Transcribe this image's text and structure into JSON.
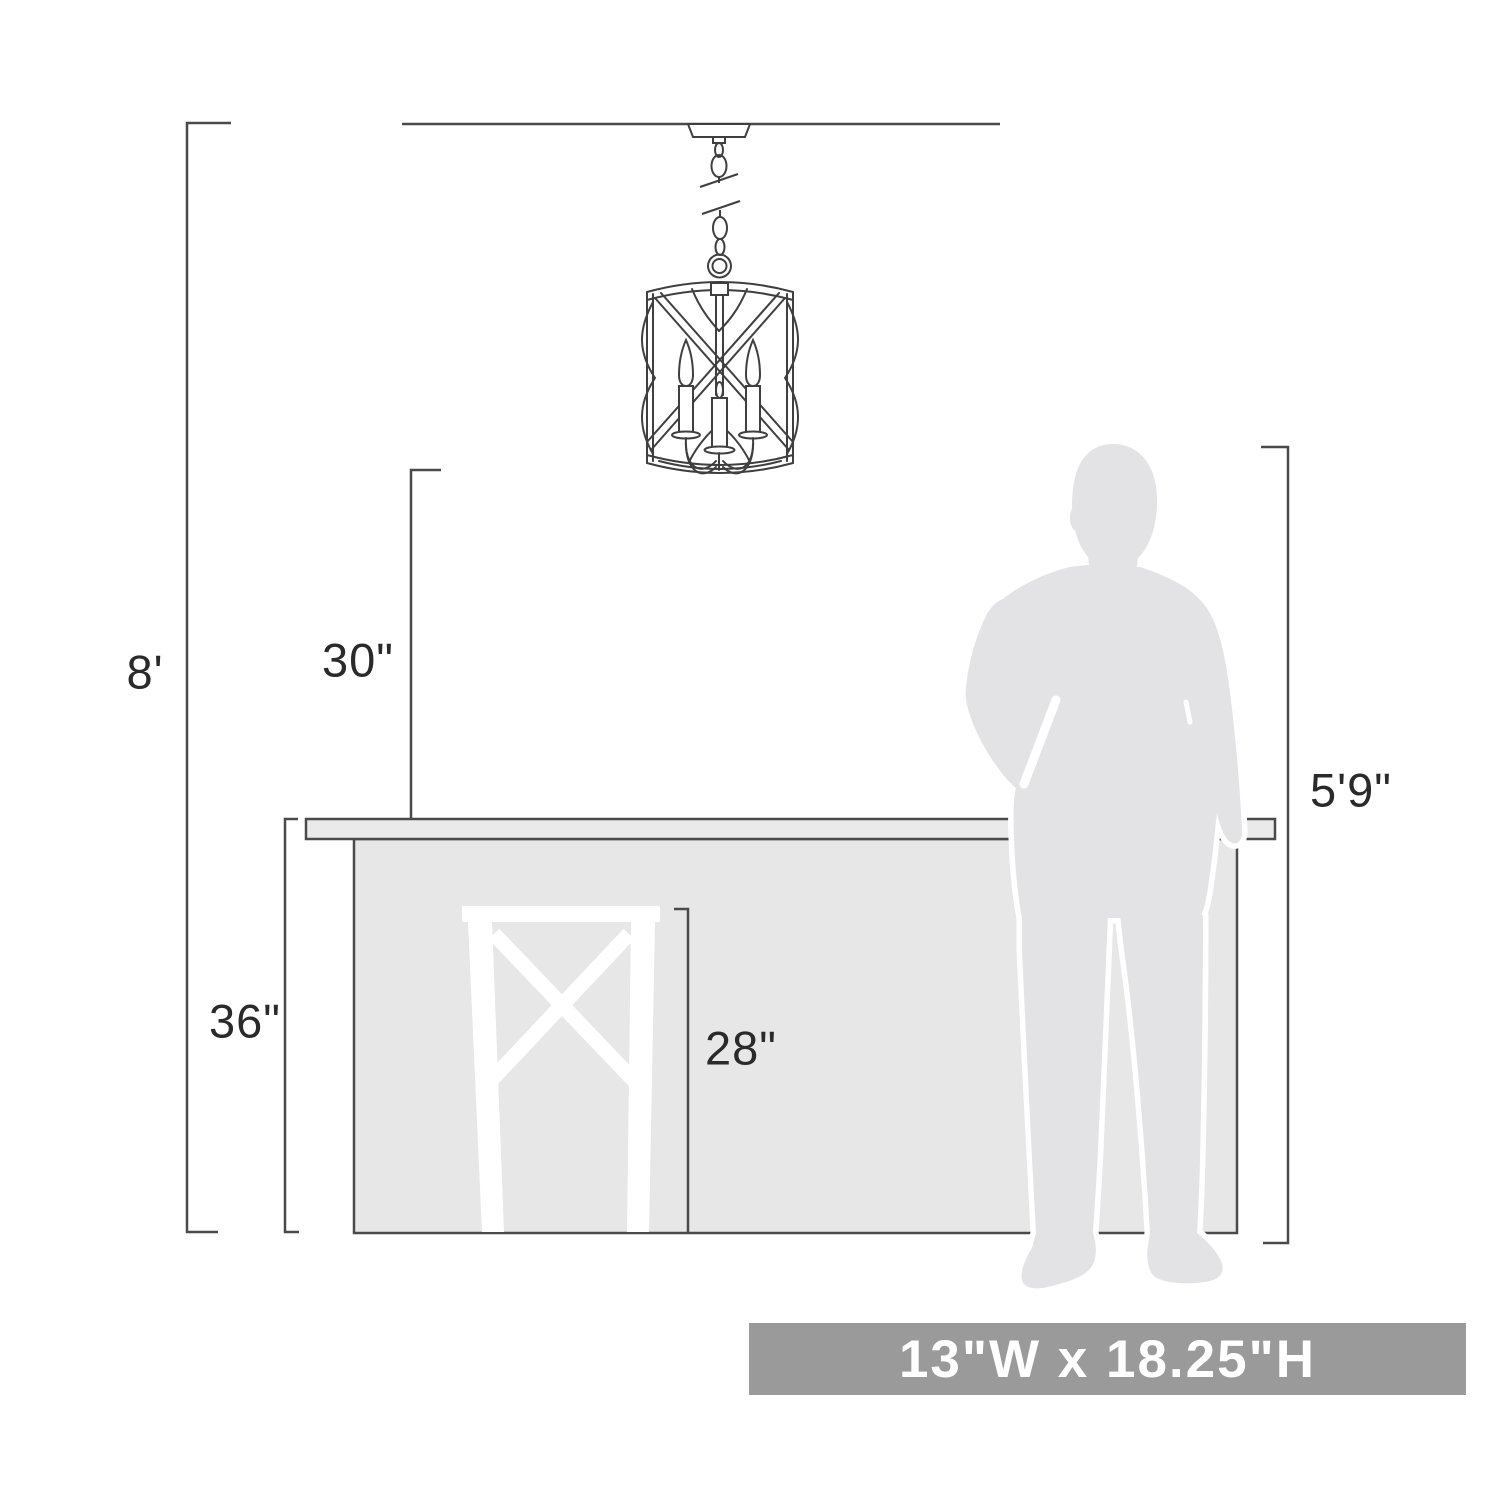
{
  "diagram": {
    "labels": {
      "ceiling_height": "8'",
      "fixture_to_counter": "30\"",
      "counter_height": "36\"",
      "stool_height": "28\"",
      "person_height": "5'9\"",
      "fixture_size": "13\"W x 18.25\"H"
    },
    "colors": {
      "line": "#4a4a4a",
      "counter_fill": "#e7e7e7",
      "counter_top_fill": "#eaeaea",
      "silhouette_fill": "#e3e3e5",
      "stool_fill": "#ffffff",
      "banner_bg": "#9a9a9a",
      "banner_text": "#ffffff",
      "label_text": "#2a2a2a",
      "background": "#ffffff"
    }
  }
}
